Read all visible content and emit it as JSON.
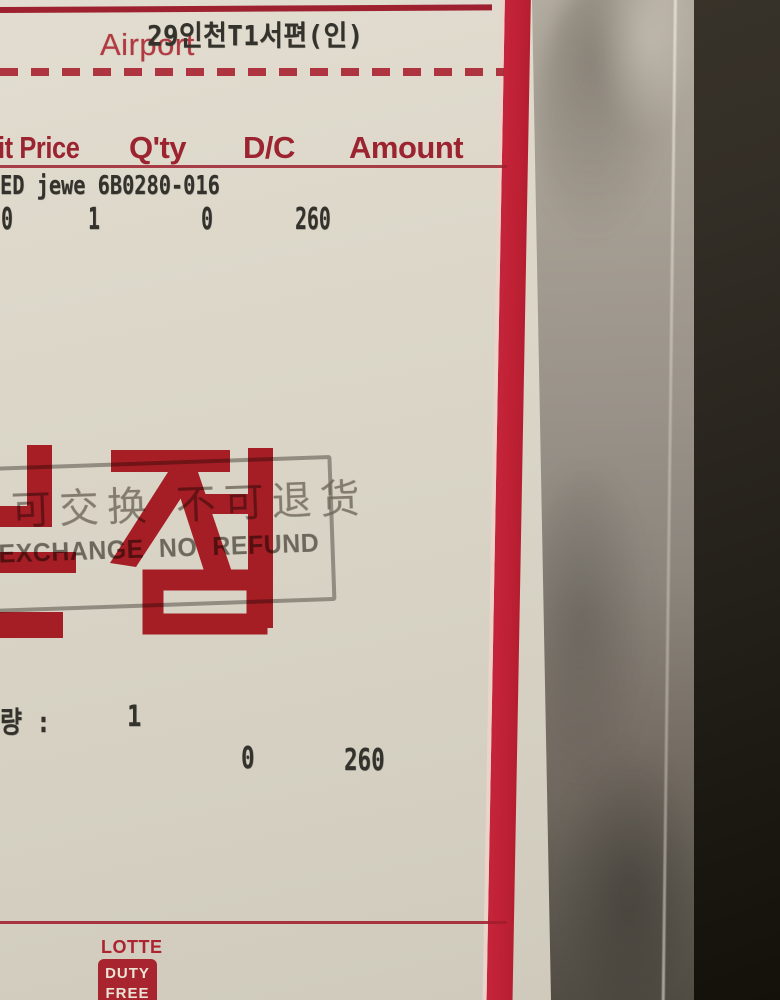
{
  "bag": {
    "airport_label": "Airport",
    "route_code": "29인천T1서편(인)",
    "table_headers": [
      "it Price",
      "Q'ty",
      "D/C",
      "Amount"
    ],
    "item_code_line": "ED jewe 6B0280-016",
    "item_values": [
      "0",
      "1",
      "0",
      "260"
    ],
    "quantity_line": {
      "label": "량 :",
      "value": "1"
    },
    "totals": {
      "dc": "0",
      "amount": "260"
    },
    "stamp": {
      "chinese_line": "可交换 不可退货",
      "english_line": "EXCHANGE NO REFUND"
    },
    "big_red_text": "본점",
    "logo": {
      "brand": "LOTTE",
      "box_line1": "DUTY",
      "box_line2": "FREE"
    }
  },
  "colors": {
    "bag_red": "#c12135",
    "header_red": "#9c2430",
    "ink_dark": "#34322c",
    "stamp_grey": "#6e6759",
    "paper": "#d9d4c6",
    "plastic_grey": "#9a948a",
    "background_dark": "#2c2820"
  }
}
